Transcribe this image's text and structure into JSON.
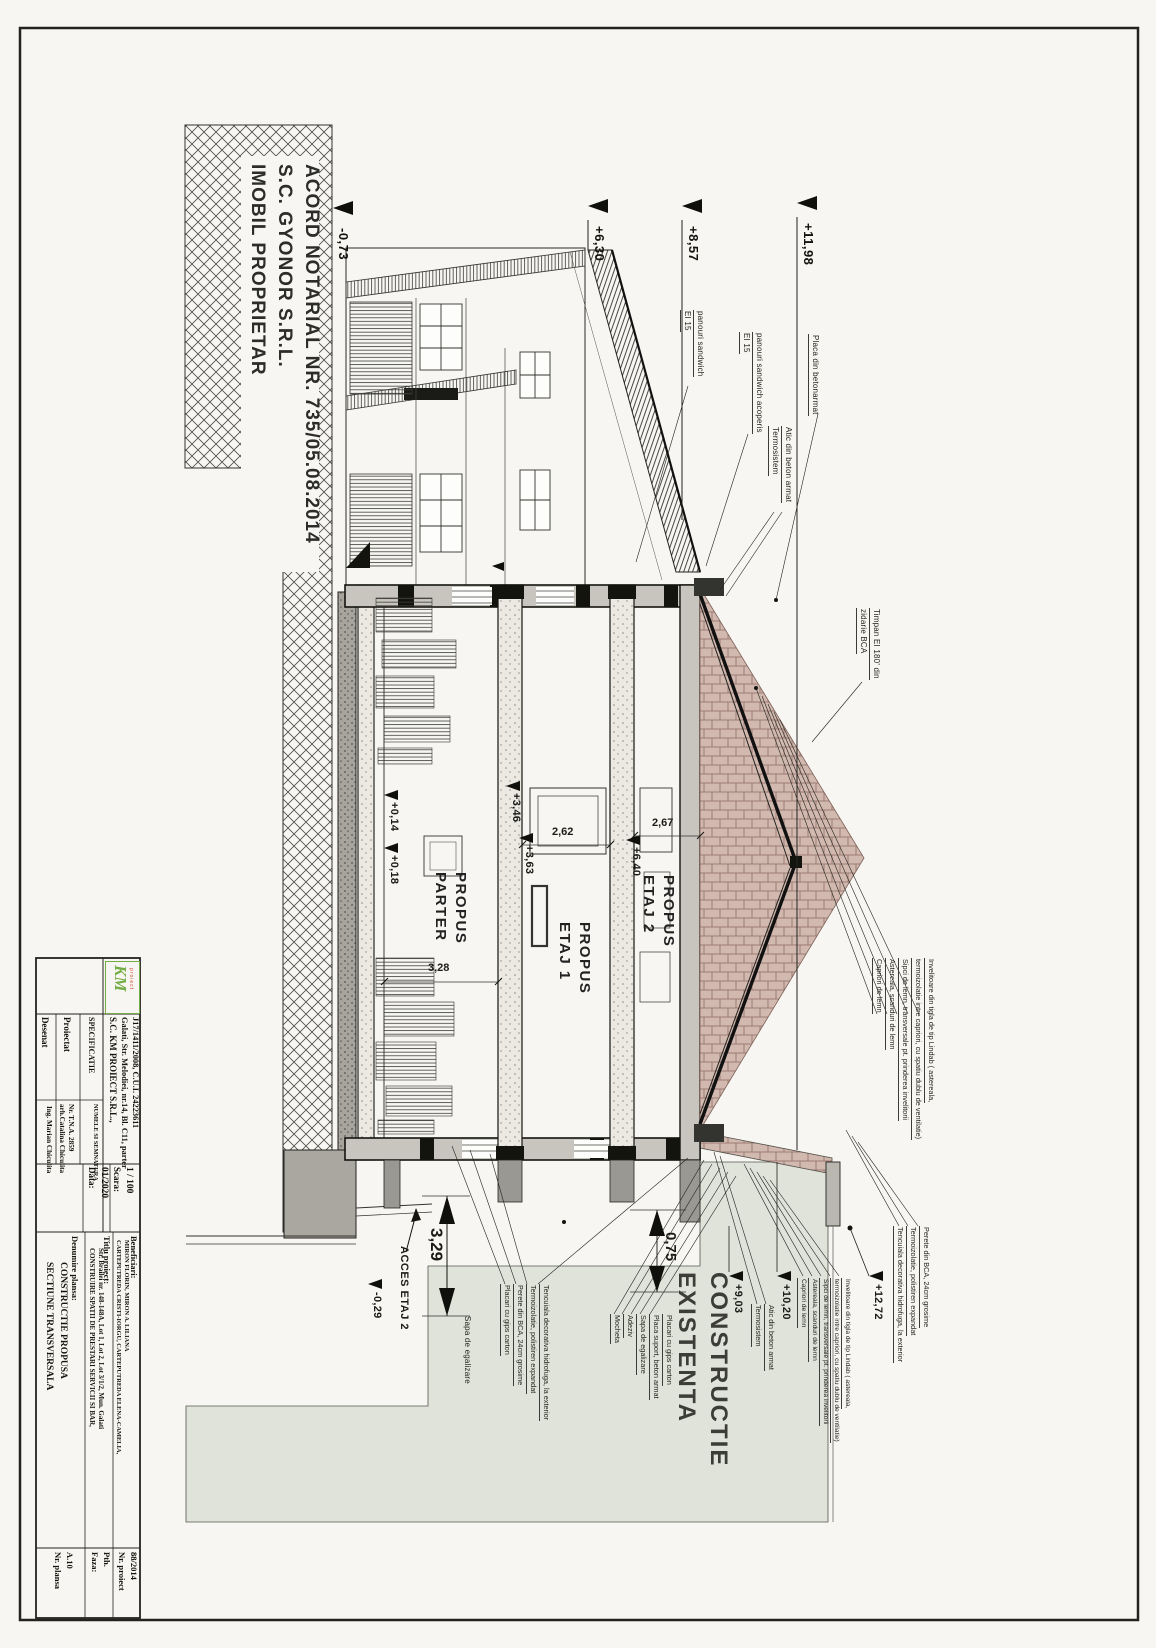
{
  "colors": {
    "logo_green": "#74ad45",
    "tint": "#dfe3d9",
    "brick": "#d0b7ae",
    "brick_line": "#9c7c72"
  },
  "drawing": {
    "property_note": [
      "IMOBIL PROPRIETAR",
      "S.C. GYONOR S.R.L.",
      "ACORD NOTARIAL NR. 735/05.08.2014"
    ],
    "rooms": {
      "parter": [
        "PARTER",
        "PROPUS"
      ],
      "etaj1": [
        "ETAJ 1",
        "PROPUS"
      ],
      "etaj2": [
        "ETAJ 2",
        "PROPUS"
      ]
    },
    "existing": [
      "CONSTRUCTIE",
      "EXISTENTA"
    ],
    "levels": {
      "lm073": "-0,73",
      "l630": "+6,30",
      "l857": "+8,57",
      "l1198": "+11,98",
      "l014": "+0,14",
      "l018": "+0,18",
      "l346": "+3,46",
      "l363": "+3,63",
      "l640": "+6,40",
      "l903": "+9,03",
      "l1020": "+10,20",
      "l1272": "+12,72",
      "lm029": "-0,29"
    },
    "dims": {
      "d328": "3,28",
      "d262": "2,62",
      "d267": "2,67",
      "d329": "3,29",
      "d075": "0,75"
    },
    "labels": {
      "acces": "ACCES ETAJ 2",
      "sapa": "Sapa de egalizare",
      "placa": "Placa din betonarmat",
      "panouri": [
        "panouri sandwich",
        "EI 15"
      ],
      "panouri_acoperis": [
        "panouri sandwich acoperis",
        "EI 15"
      ],
      "atic": [
        "Atic din beton armat",
        "Termosistem"
      ],
      "timpan": [
        "Timpan EI 180' din",
        "zidarie BCA"
      ],
      "roof_layers": [
        "Invelitoare din tigla de tip Lindab ( astereala,",
        "termoizolatie intre capriori, cu spatiu dublu de ventilatie)",
        "Sipci de lemn, transversale pt. prinderea invelitorii",
        "Astereala, scanduri de lemn",
        "Capriori de lemn"
      ],
      "wall_layers": [
        "Placari cu gips carton",
        "Perete din BCA, 24cm grosime",
        "Termoizolatie, polistiren expandat",
        "Tencuiala decorativa hidrofuga, la exterior"
      ],
      "floor_layers": [
        "Mocheta",
        "Adeziv",
        "Sapa de egalizare",
        "Placa suport, beton armat",
        "Placari cu gips carton"
      ],
      "bca_layers": [
        "Perete din BCA, 24cm grosime",
        "Termoizolatie, polistiren expandat",
        "Tencuiala decorativa hidrofuga, la exterior"
      ]
    }
  },
  "titleblock": {
    "logo": {
      "mark": "KM",
      "sub": "proiect"
    },
    "company": [
      "S.C. KM PROIECT S.R.L.,",
      "Galati, Str. Melodiei, nr.14, Bl. C11, parter",
      "J17/1411/2008, C.U.I. 24223611"
    ],
    "spec": {
      "header": "SPECIFICATIE",
      "name_header": "NUMELE SI SEMNATURA",
      "proiectat": {
        "label": "Proiectat",
        "name": "arh.Catalina Chiculita",
        "detail": "Nr. T.N.A. 2859"
      },
      "desenat": {
        "label": "Desenat",
        "name": "Ing. Marian Chiculita"
      }
    },
    "scara": {
      "label": "Scara:",
      "value": "1 / 100"
    },
    "data": {
      "label": "Data:",
      "value": "01/2020"
    },
    "beneficiari": {
      "label": "Beneficiari:",
      "lines": [
        "CARTEPUTREDA CRISTI-IORGU, CARTEPUTREDA ELENA-CAMELIA,",
        "MIRON FLORIN, MIRON A. LILIANA"
      ]
    },
    "titlu": {
      "label": "Titlu proiect:",
      "lines": [
        "CONSTRUIRE SPATII DE PRESTARI SERVICII SI BAR,",
        "Str. Brailei nr. 148-148A, Lot 1, Lot 2, Lot 3/1/2, Mun. Galati"
      ]
    },
    "denumire": {
      "label": "Denumire plansa:",
      "lines": [
        "SECTIUNE TRANSVERSALA",
        "CONSTRUCTIE PROPUSA"
      ]
    },
    "nr_proiect": {
      "label": "Nr. proiect",
      "value": "88/2014"
    },
    "faza": {
      "label": "Faza:",
      "value": "Pth."
    },
    "nr_plansa": {
      "label": "Nr. plansa",
      "value": "A.10"
    }
  }
}
